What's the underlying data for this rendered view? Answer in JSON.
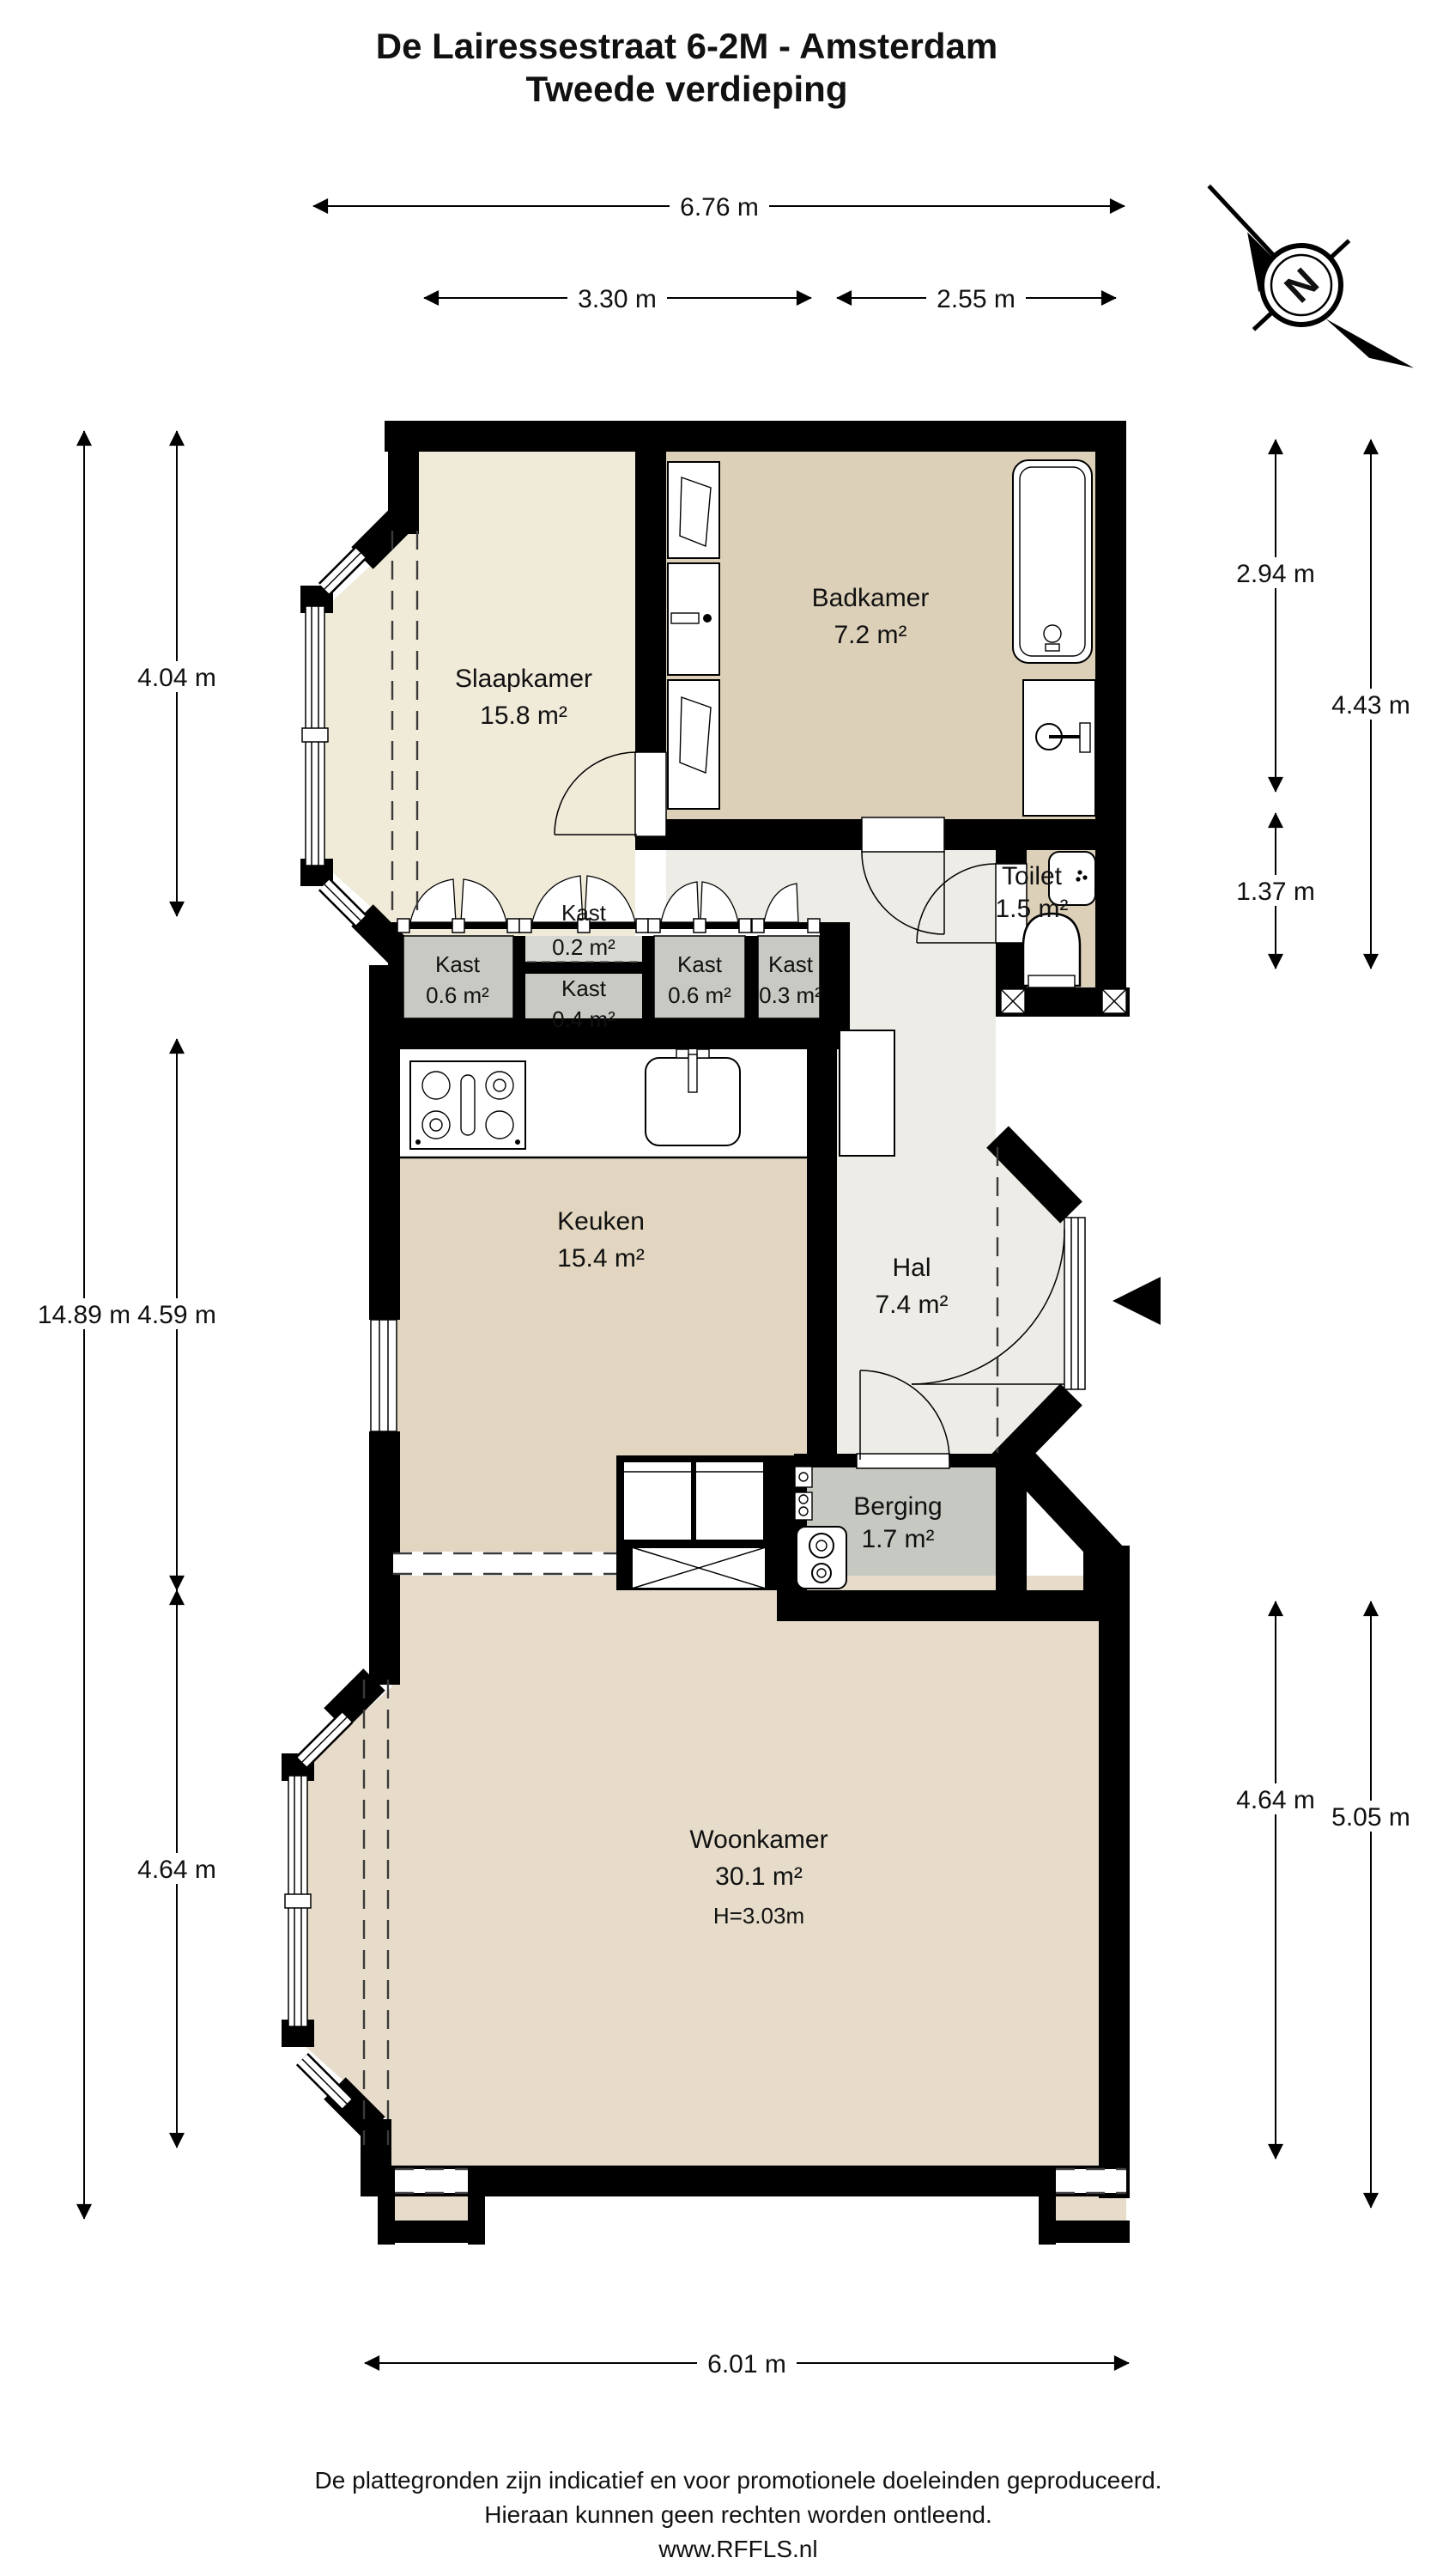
{
  "title": {
    "line1": "De Lairessestraat 6-2M - Amsterdam",
    "line2": "Tweede verdieping"
  },
  "compass": {
    "letter": "N"
  },
  "rooms": {
    "slaapkamer": {
      "name": "Slaapkamer",
      "area": "15.8 m²"
    },
    "badkamer": {
      "name": "Badkamer",
      "area": "7.2 m²"
    },
    "toilet": {
      "name": "Toilet",
      "area": "1.5 m²"
    },
    "kast1": {
      "name": "Kast",
      "area": "0.6 m²"
    },
    "kast2": {
      "name": "Kast",
      "area": "0.2 m²"
    },
    "kast3": {
      "name": "Kast",
      "area": "0.4 m²"
    },
    "kast4": {
      "name": "Kast",
      "area": "0.6 m²"
    },
    "kast5": {
      "name": "Kast",
      "area": "0.3 m²"
    },
    "keuken": {
      "name": "Keuken",
      "area": "15.4 m²"
    },
    "hal": {
      "name": "Hal",
      "area": "7.4 m²"
    },
    "berging": {
      "name": "Berging",
      "area": "1.7 m²"
    },
    "woonkamer": {
      "name": "Woonkamer",
      "area": "30.1 m²",
      "height": "H=3.03m"
    }
  },
  "dims": {
    "top_total": "6.76 m",
    "top_left": "3.30 m",
    "top_right": "2.55 m",
    "left_total": "14.89 m",
    "left_top": "4.04 m",
    "left_mid": "4.59 m",
    "left_bottom": "4.64 m",
    "right_top_inner": "2.94 m",
    "right_mid_inner": "1.37 m",
    "right_top_outer": "4.43 m",
    "right_bottom_inner": "4.64 m",
    "right_bottom_outer": "5.05 m",
    "bottom_total": "6.01 m"
  },
  "footer": {
    "line1": "De plattegronden zijn indicatief en voor promotionele doeleinden geproduceerd.",
    "line2": "Hieraan kunnen geen rechten worden ontleend.",
    "line3": "www.RFFLS.nl"
  },
  "colors": {
    "wall": "#000000",
    "bedroom": "#f0ead9",
    "bathroom": "#dcd0b8",
    "kitchen": "#e2d6c0",
    "living": "#e7dcca",
    "hall": "#edece6",
    "closet": "#c9c9c3",
    "closet_light": "#d8d8d2",
    "storage": "#c6c8c2"
  }
}
